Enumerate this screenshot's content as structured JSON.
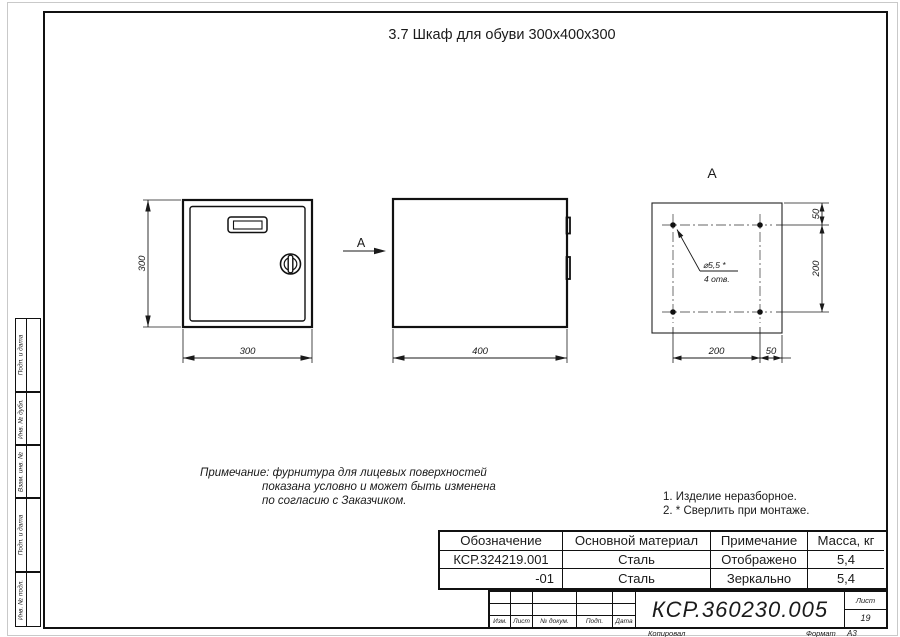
{
  "sheet": {
    "title": "3.7 Шкаф для обуви 300х400х300",
    "copied_label": "Копировал",
    "format_label": "Формат",
    "format_value": "А3"
  },
  "views": {
    "front": {
      "height_dim": "300",
      "width_dim": "300"
    },
    "side": {
      "width_dim": "400",
      "arrow_label": "А"
    },
    "back": {
      "label": "А",
      "edge_offset_v_dim": "50",
      "hole_spacing_v_dim": "200",
      "hole_spacing_h_dim": "200",
      "edge_offset_h_dim": "50",
      "hole_callout_line1": "⌀5,5 *",
      "hole_callout_line2": "4 отв."
    }
  },
  "note": {
    "line1": "Примечание: фурнитура для лицевых поверхностей",
    "line2": "показана условно и может быть изменена",
    "line3": "по согласию с Заказчиком."
  },
  "tech_notes": {
    "line1": "1. Изделие неразборное.",
    "line2": "2. * Сверлить при монтаже."
  },
  "table": {
    "headers": [
      "Обозначение",
      "Основной материал",
      "Примечание",
      "Масса, кг"
    ],
    "rows": [
      [
        "КСР.324219.001",
        "Сталь",
        "Отображено",
        "5,4"
      ],
      [
        "-01",
        "Сталь",
        "Зеркально",
        "5,4"
      ]
    ]
  },
  "title_block": {
    "doc_number": "КСР.360230.005",
    "col_labels": [
      "Изм.",
      "Лист",
      "№ докум.",
      "Подп.",
      "Дата"
    ],
    "sheet_label": "Лист",
    "sheet_number": "19"
  },
  "side_stamps": [
    "Подп. и дата",
    "Инв. № дубл.",
    "Взам. инв. №",
    "Подп. и дата",
    "Инв. № подл."
  ],
  "colors": {
    "line": "#1a1a1a",
    "frame": "#111111",
    "faint_border": "#c9c9c9",
    "background": "#ffffff"
  }
}
